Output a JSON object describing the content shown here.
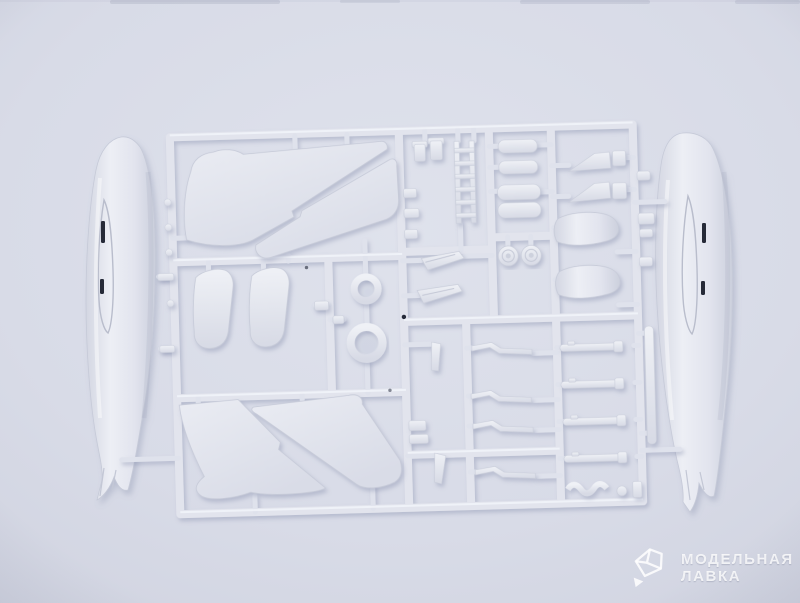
{
  "photo": {
    "subject": "injection-molded plastic model kit sprue with aircraft parts photographed on a pale background",
    "background_color": "#d6d9e5",
    "plastic_color": "#e6e8f0",
    "plastic_shadow_color": "#c7cbd9",
    "panel_slit_color": "#252a38",
    "drop_shadow_color": "#7e86a6"
  },
  "watermark": {
    "line1": "МОДЕЛЬНАЯ",
    "line2": "ЛАВКА",
    "logo": "crystal-gem",
    "color": "#ffffff",
    "opacity": 0.8
  },
  "scene": {
    "parts": [
      "fuselage half (left)",
      "fuselage half (right)",
      "upper wing panel pair with diagonal gap",
      "lower wing panel pair with diagonal gap",
      "intake fin pieces",
      "small ring part",
      "large ring part",
      "ejection seat ladder",
      "bomb / cylinder bodies",
      "main wheels",
      "exhaust wedge pieces",
      "drop tank halves",
      "landing gear struts",
      "missile rods",
      "canopy frame quads",
      "antenna blades",
      "sprue frame runners and gates"
    ]
  }
}
